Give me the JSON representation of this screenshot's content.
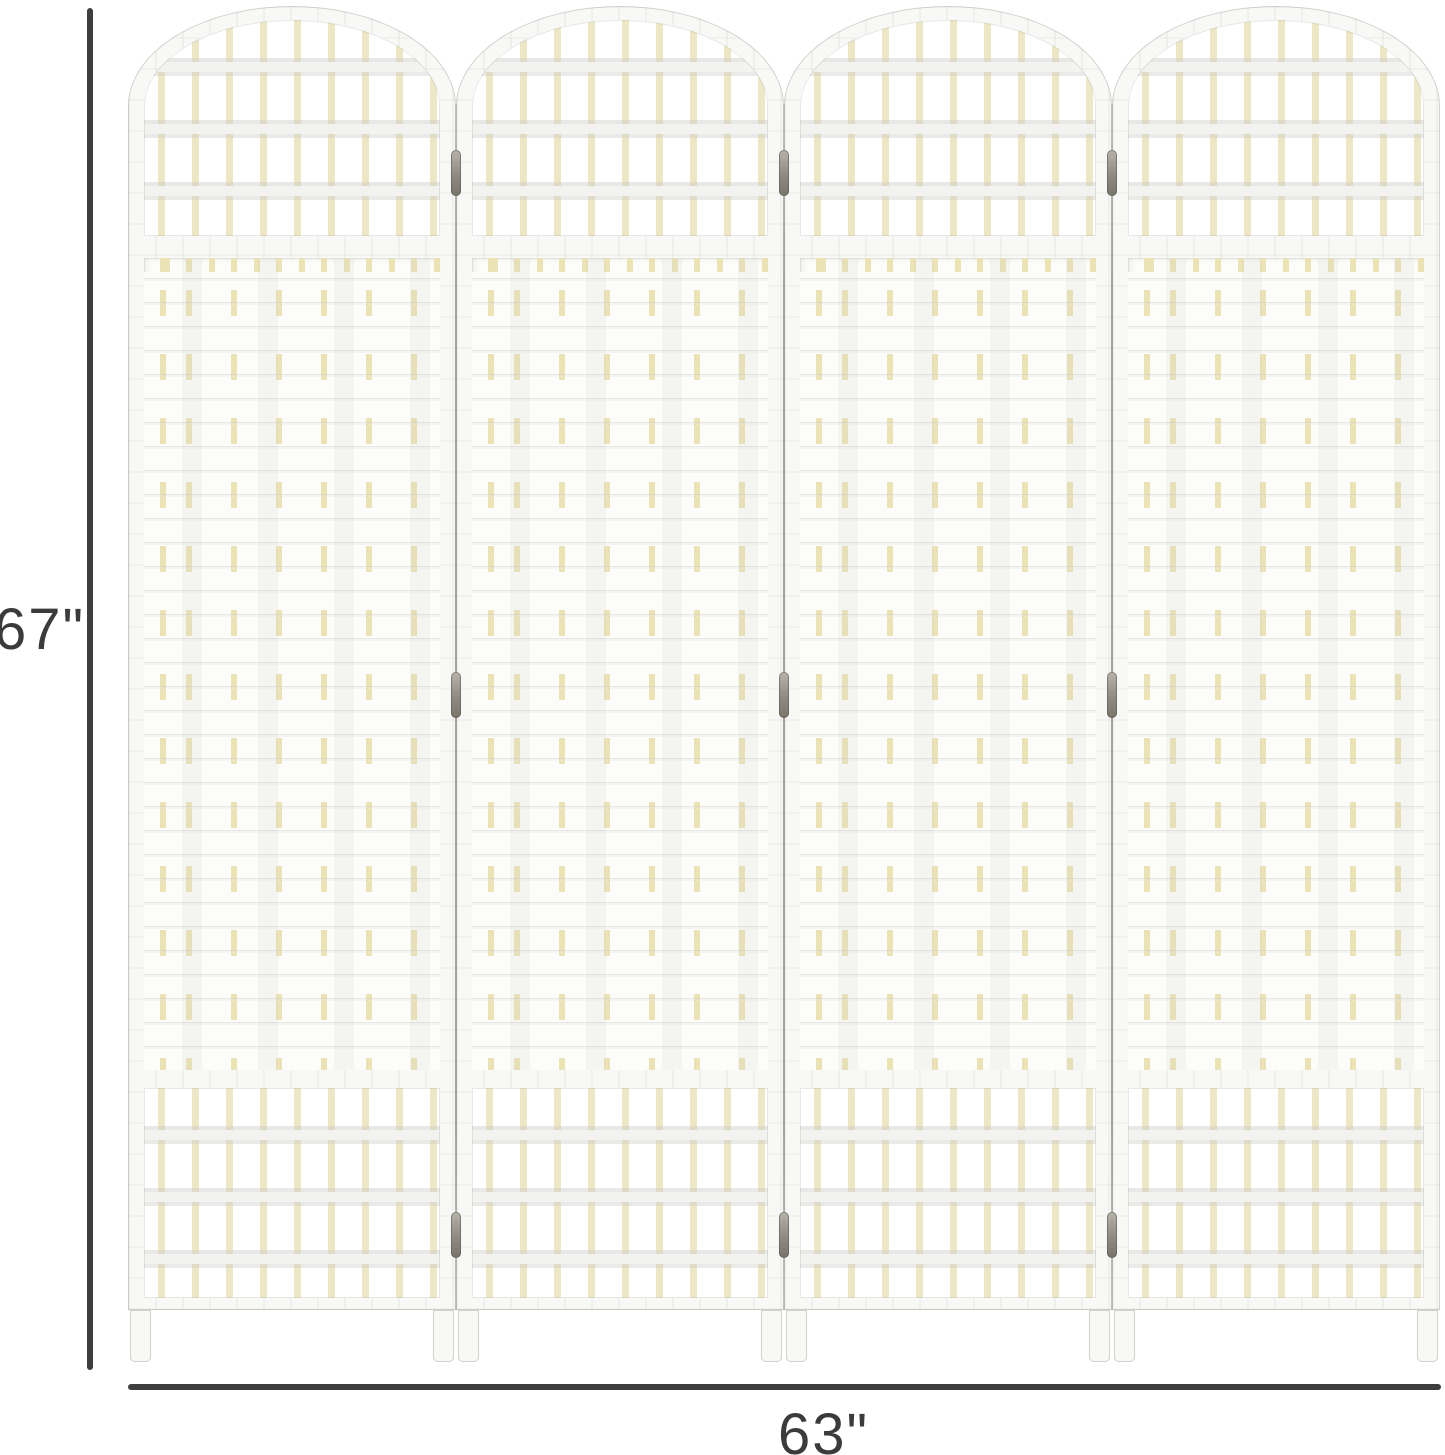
{
  "image_type": "product dimension diagram",
  "divider": {
    "panel_count": 4,
    "style": "arched-top woven fiber folding screen",
    "colors": {
      "frame_white": "#f8f8f6",
      "weave_white": "#fcfcfa",
      "dowel_cream": "#eee7c6",
      "dash_cream": "#ece3b4",
      "hinge_metal": "#8f8a80",
      "background": "#ffffff"
    }
  },
  "annotations": {
    "height_label": "67\"",
    "width_label": "63\"",
    "line_color": "#3e3e3e",
    "text_color": "#3b3b3b"
  }
}
